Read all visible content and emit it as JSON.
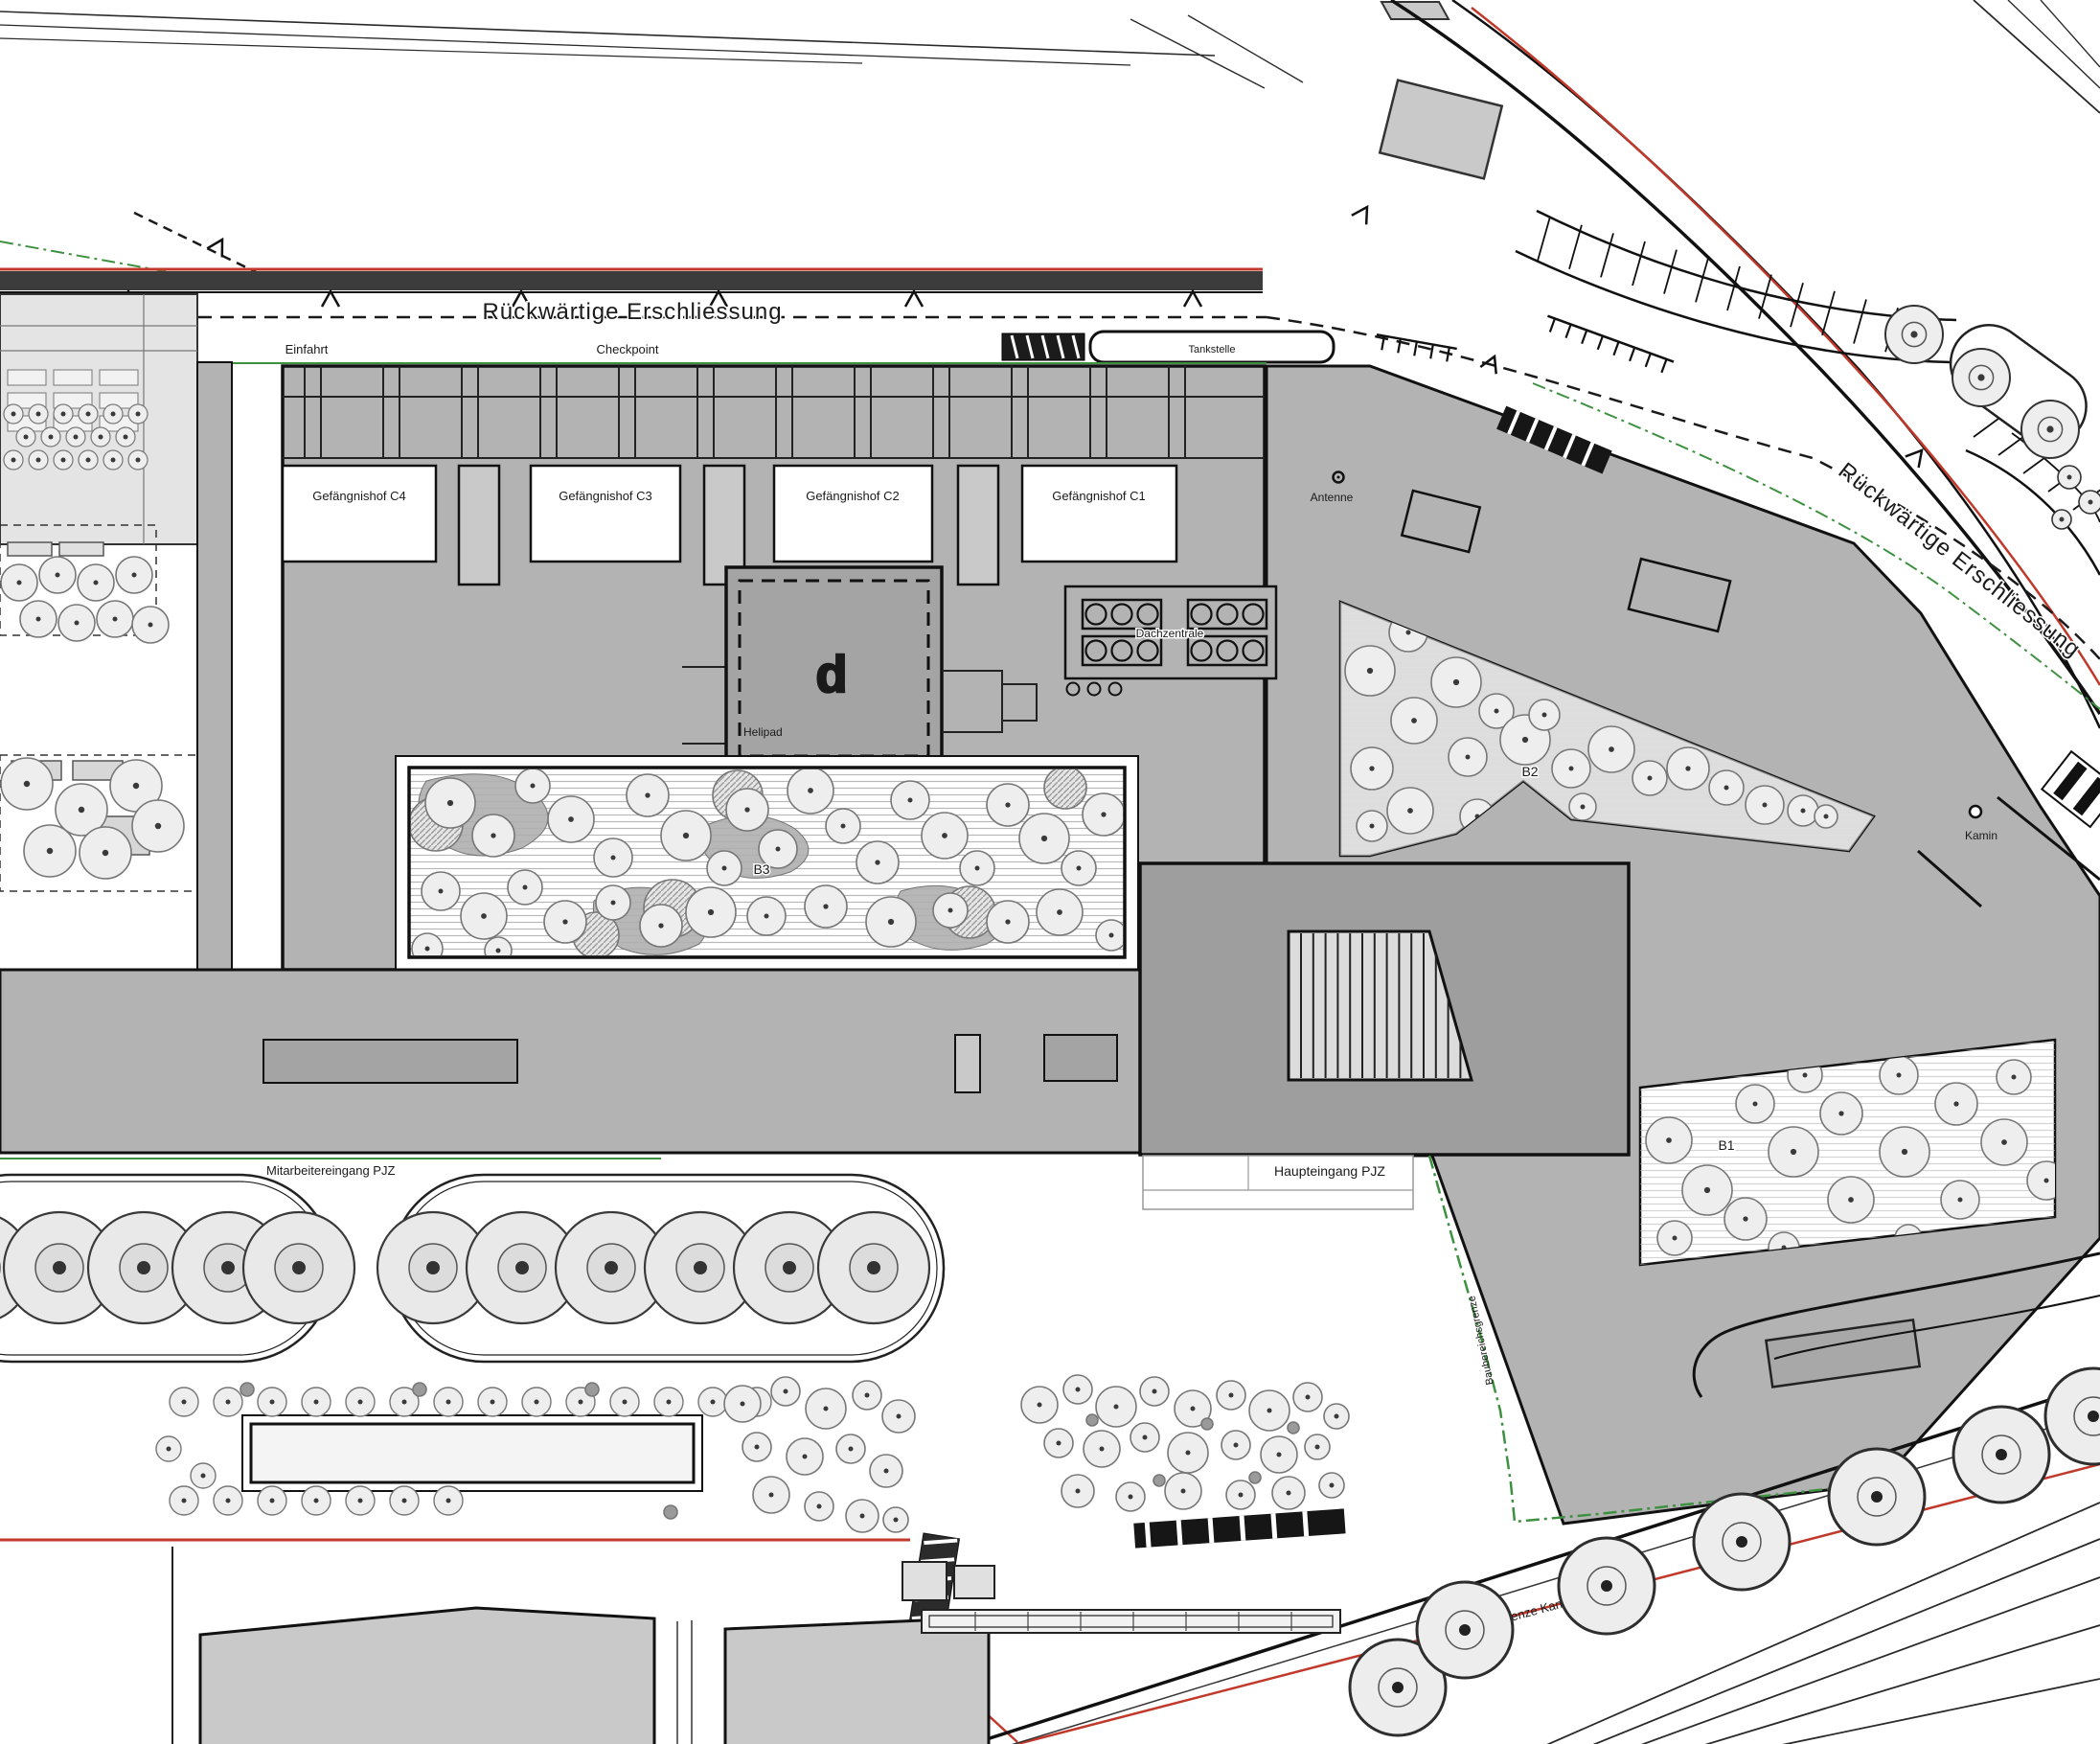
{
  "roads": {
    "rear_top": "Rückwärtige Erschliessung",
    "rear_right": "Rückwärtige Erschliessung"
  },
  "access": {
    "einfahrt": "Einfahrt",
    "checkpoint": "Checkpoint",
    "tankstelle": "Tankstelle"
  },
  "courtyards": {
    "c4": "Gefängnishof C4",
    "c3": "Gefängnishof C3",
    "c2": "Gefängnishof C2",
    "c1": "Gefängnishof C1"
  },
  "roof": {
    "dachzentrale": "Dachzentrale",
    "helipad": "Helipad",
    "helipad_mark": "d",
    "antenne": "Antenne",
    "kamin": "Kamin"
  },
  "gardens": {
    "b1": "B1",
    "b2": "B2",
    "b3": "B3"
  },
  "entrances": {
    "staff": "Mitarbeitereingang PJZ",
    "main": "Haupteingang PJZ"
  },
  "boundaries": {
    "property": "Grundstücksgrenze Kanton Zürich",
    "construction": "Baubereichsgrenze"
  },
  "colors": {
    "roof_gray": "#b3b3b3",
    "entrance_gray": "#9e9e9e",
    "panel_gray": "#e4e4e4",
    "line_black": "#1a1a1a",
    "boundary_red": "#c0392b",
    "boundary_green": "#3f9142",
    "tree_fill": "#ececec",
    "wall_dark": "#3c3c3c"
  }
}
